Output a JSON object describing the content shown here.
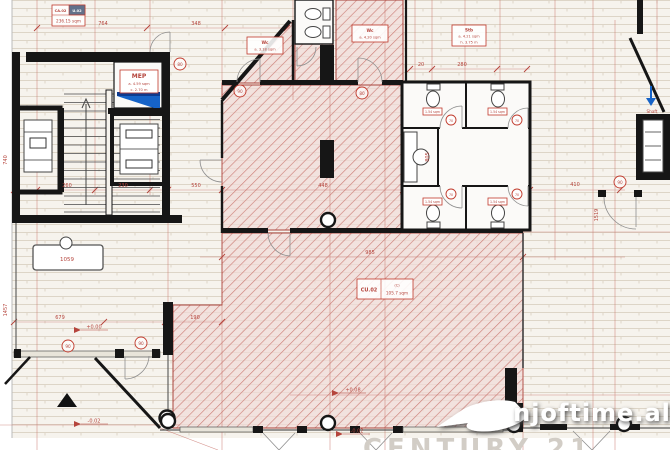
{
  "watermark": {
    "brand": "njoftime.al",
    "agency": "CENTURY 21"
  },
  "units": {
    "top": {
      "code": "CA.02",
      "suite": "U.02",
      "area": "236.15 sqm"
    },
    "main": {
      "code": "CU.02",
      "tag": "(C)",
      "area": "105.7 sqm"
    },
    "mep": {
      "name": "MEP",
      "area": "a. 4.59 sqm",
      "height": "c. 2.70 m"
    },
    "wc_top": {
      "name": "Wc",
      "area": "a. 3.18 sqm"
    },
    "wc_mid": {
      "name": "Wc",
      "area": "a. 4.20 sqm"
    },
    "stb": {
      "name": "Stb",
      "area": "a. 4.21 sqm",
      "height": "h. 3.75 m"
    },
    "stall": {
      "area": "1.54 sqm"
    },
    "shaft": {
      "name": "Shaft"
    },
    "desk": {
      "label": "1059"
    }
  },
  "dims": {
    "d764": "764",
    "d348": "348",
    "d20": "20",
    "d280": "280",
    "d260": "260",
    "d230": "230",
    "d550": "550",
    "d448": "448",
    "d410": "410",
    "d985": "985",
    "d679": "679",
    "d190": "190",
    "d740": "740",
    "d1457": "1457",
    "d1519": "1519",
    "d805": "805"
  },
  "levels": {
    "entry_top": "+0.00",
    "entry_bottom": "-0.02",
    "shop_front": "+0.08",
    "shop_front_low": "-0.02"
  },
  "door_tags": {
    "t70": "70",
    "t80": "80",
    "t90": "90"
  },
  "colors": {
    "hatch_red": "#cc8079",
    "dim_red": "#b5443c",
    "wall_black": "#161616",
    "accent_blue": "#1663c7",
    "brand_white": "#ffffff",
    "agency_gray": "#d2cdc6"
  }
}
